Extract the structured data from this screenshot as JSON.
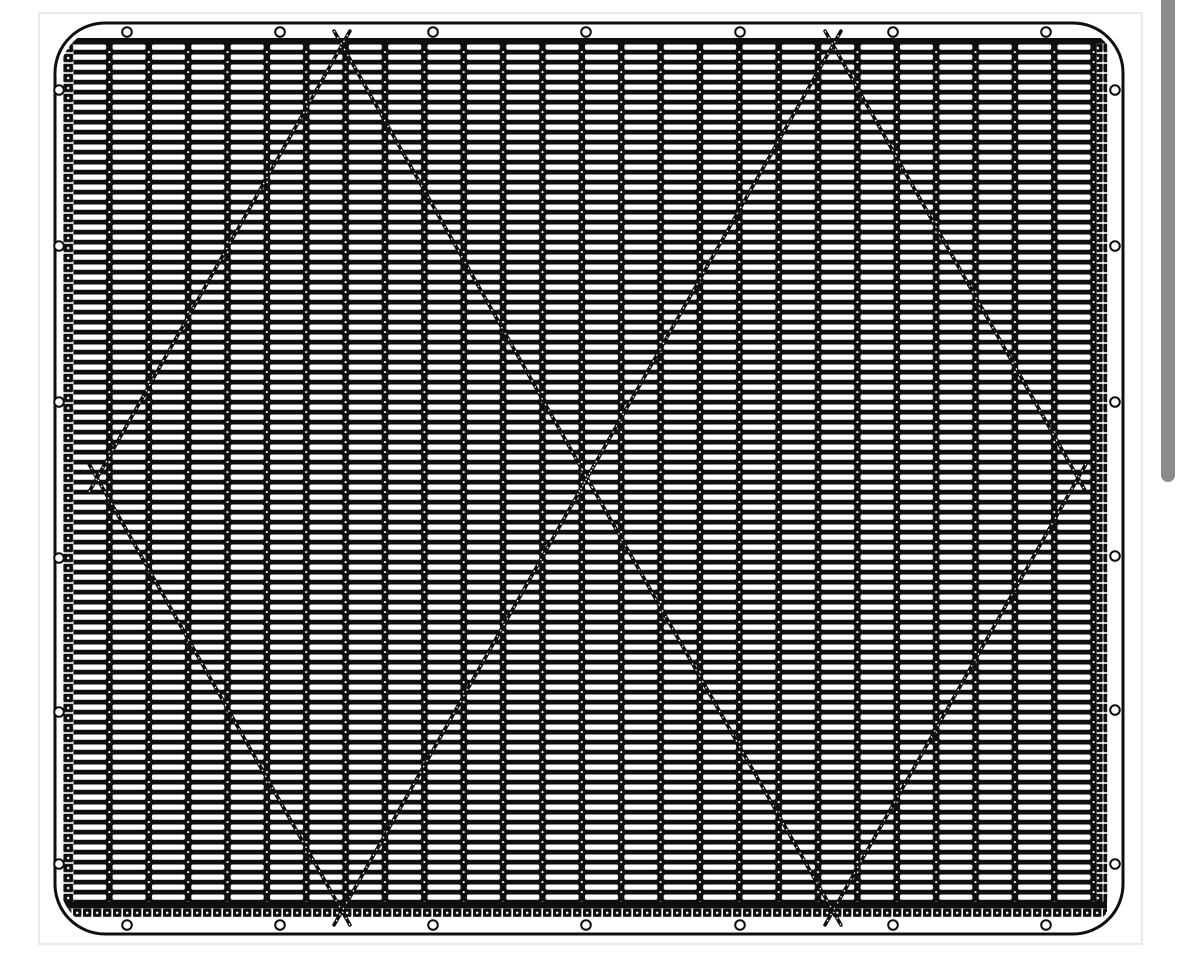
{
  "app": {
    "background": "#ffffff",
    "card_border_color": "#e9e9e9",
    "ink_color": "#0f0f0f",
    "paper_color": "#ffffff"
  },
  "scrollbar": {
    "thumb_color": "#8b8b8b",
    "track_color": "#ffffff",
    "thumb_width": 14,
    "thumb_top": -10,
    "thumb_height": 492,
    "thumb_radius": 7
  },
  "drawing": {
    "card": {
      "x": 38,
      "y": 12,
      "width": 1105,
      "height": 933
    },
    "panel": {
      "x": 55,
      "y": 23,
      "width": 1068,
      "height": 911,
      "corner_radius": 50,
      "stroke_width": 3
    },
    "mesh_clip": {
      "x": 60,
      "y": 28,
      "width": 1058,
      "height": 901,
      "radius": 46
    },
    "mesh": {
      "slat_area": {
        "x": 73.2,
        "y": 43.5,
        "width": 1023.6,
        "height": 859
      },
      "column_pitch": 39.37,
      "row_pitch": 10,
      "slot": {
        "width": 33,
        "height": 5.3,
        "radius": 1.7,
        "y_offset": 0.95
      },
      "separator_dot": {
        "cx": 36.18,
        "cy": 8.6,
        "r": 1.05
      },
      "top_cap": {
        "x": 63,
        "y": 38,
        "width": 1044,
        "height": 5.8
      },
      "bottom_cap": {
        "x": 63,
        "y": 901.5,
        "width": 1044,
        "height": 7
      },
      "bottom_stitch": {
        "x": 63,
        "y": 908.5,
        "width": 1044,
        "height": 8.6,
        "pitch": 10
      },
      "left_binding": {
        "x": 63,
        "y": 43.8,
        "width": 10.4,
        "height": 857.7
      },
      "right_binding": {
        "x": 1096.8,
        "y": 43.8,
        "width": 10.4,
        "height": 857.7
      },
      "binding_pitch": 10
    },
    "diamonds": {
      "stroke_width": 3.6,
      "overshoot": 16,
      "stitch": {
        "color": "#ffffff",
        "width": 1.25,
        "dash": "1.6 5.2"
      },
      "left": {
        "vertices": [
          [
            97,
            478
          ],
          [
            342,
            45
          ],
          [
            587,
            478
          ],
          [
            342,
            911
          ]
        ]
      },
      "right": {
        "vertices": [
          [
            587,
            478
          ],
          [
            833,
            45
          ],
          [
            1078,
            478
          ],
          [
            833,
            911
          ]
        ]
      }
    },
    "grommets": {
      "radius": 4.8,
      "ring_width": 2,
      "top": {
        "y": 32,
        "xs": [
          127,
          280,
          433,
          586,
          740,
          893,
          1046
        ]
      },
      "bottom": {
        "y": 925,
        "xs": [
          127,
          280,
          433,
          586,
          740,
          893,
          1046
        ]
      },
      "left": {
        "x": 59,
        "ys": [
          90,
          246,
          402,
          558,
          712,
          864
        ]
      },
      "right": {
        "x": 1115,
        "ys": [
          90,
          246,
          402,
          556,
          710,
          864
        ]
      }
    }
  }
}
